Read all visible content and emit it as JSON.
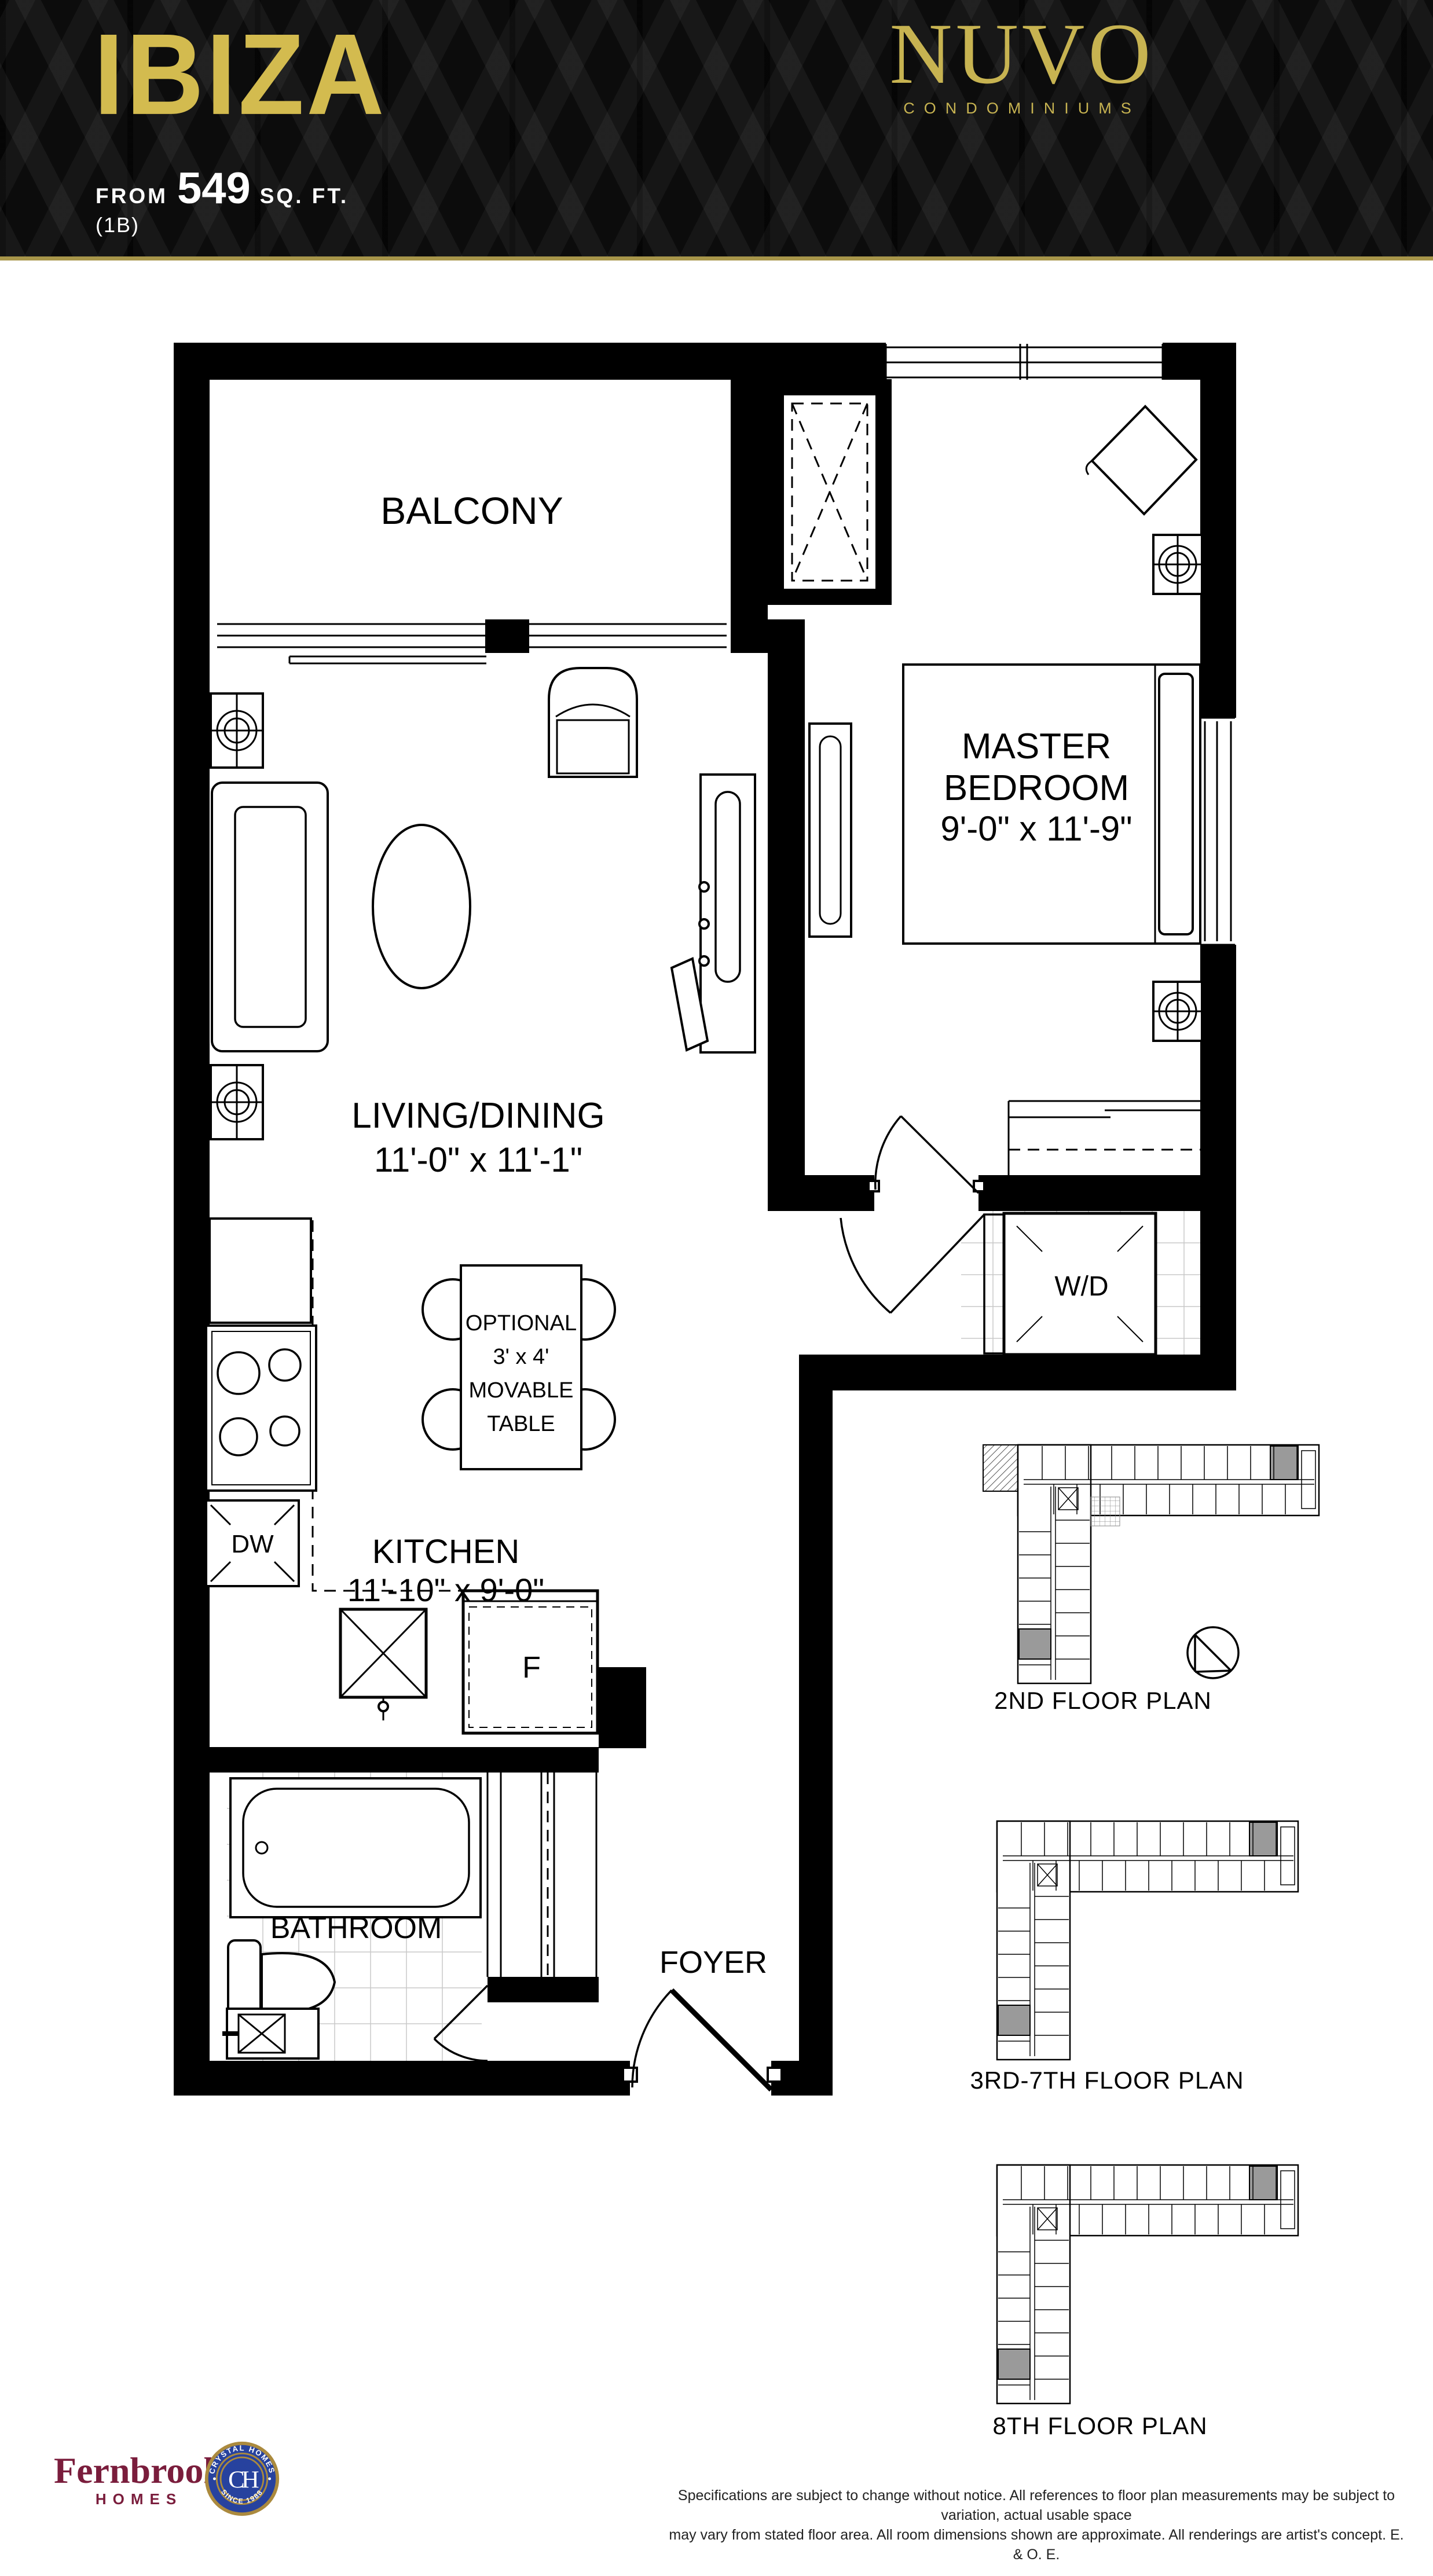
{
  "header": {
    "plan_name": "IBIZA",
    "from_label": "FROM",
    "area_value": "549",
    "area_unit": "SQ. FT.",
    "plan_code": "(1B)",
    "brand": {
      "name": "NUVO",
      "tagline": "CONDOMINIUMS"
    }
  },
  "floor_plan": {
    "rooms": {
      "balcony": "BALCONY",
      "master_bedroom_line1": "MASTER",
      "master_bedroom_line2": "BEDROOM",
      "master_bedroom_dims": "9'-0\" x 11'-9\"",
      "living_dining": "LIVING/DINING",
      "living_dining_dims": "11'-0\" x 11'-1\"",
      "kitchen": "KITCHEN",
      "kitchen_dims": "11'-10\" x 9'-0\"",
      "bathroom": "BATHROOM",
      "foyer": "FOYER"
    },
    "fixtures": {
      "washer_dryer": "W/D",
      "dishwasher": "DW",
      "fridge": "F",
      "optional_table": [
        "OPTIONAL",
        "3' x 4'",
        "MOVABLE",
        "TABLE"
      ]
    }
  },
  "key_plans": [
    {
      "caption": "2ND FLOOR PLAN"
    },
    {
      "caption": "3RD-7TH FLOOR PLAN"
    },
    {
      "caption": "8TH FLOOR PLAN"
    }
  ],
  "footer": {
    "fernbrook_name": "Fernbrook",
    "fernbrook_sub": "HOMES",
    "crystal_arc_top": "CRYSTAL HOMES",
    "crystal_arc_bottom": "SINCE 1988",
    "crystal_monogram": "CH",
    "disclaimer_line1": "Specifications are subject to change without notice. All references to floor plan measurements may be subject to variation, actual usable space",
    "disclaimer_line2": "may vary from stated floor area. All room dimensions shown are approximate. All renderings are artist's concept. E. & O. E."
  },
  "colors": {
    "accent_gold": "#d3bb4f",
    "brand_gold": "#c7b351",
    "rule_gold": "#a8964a",
    "fernbrook_maroon": "#7a1d3c",
    "crystal_blue": "#27429e",
    "crystal_gold": "#ab8a3e",
    "keyplan_highlight": "#9a9a9a"
  }
}
